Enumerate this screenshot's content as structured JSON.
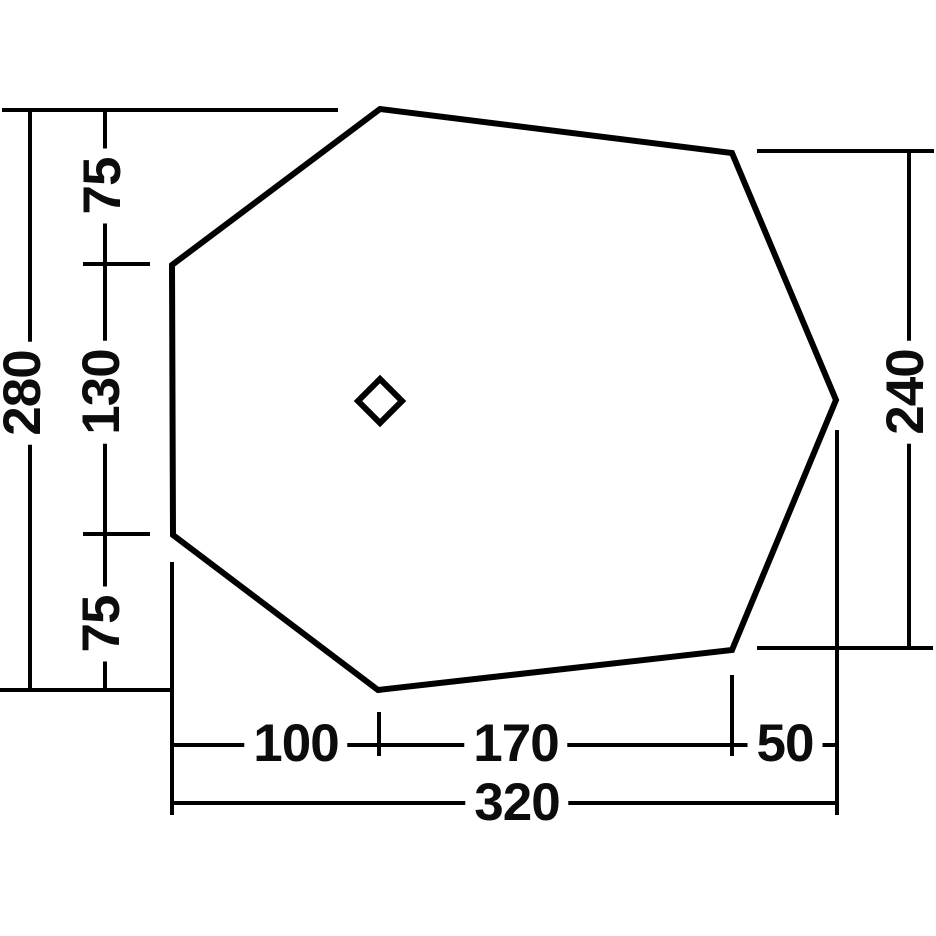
{
  "diagram": {
    "kind": "dimension-drawing",
    "subject": "tent-footprint-plan",
    "units_shown": false,
    "colors": {
      "line": "#000000",
      "background": "#ffffff",
      "text": "#0c0c0c"
    },
    "dimensions": {
      "left_total_height": "280",
      "left_top_segment": "75",
      "left_middle_segment": "130",
      "left_bottom_segment": "75",
      "right_height": "240",
      "bottom_left_segment": "100",
      "bottom_middle_segment": "170",
      "bottom_right_segment": "50",
      "bottom_total_width": "320"
    },
    "icons": {
      "center_marker": "diamond-outline"
    }
  }
}
